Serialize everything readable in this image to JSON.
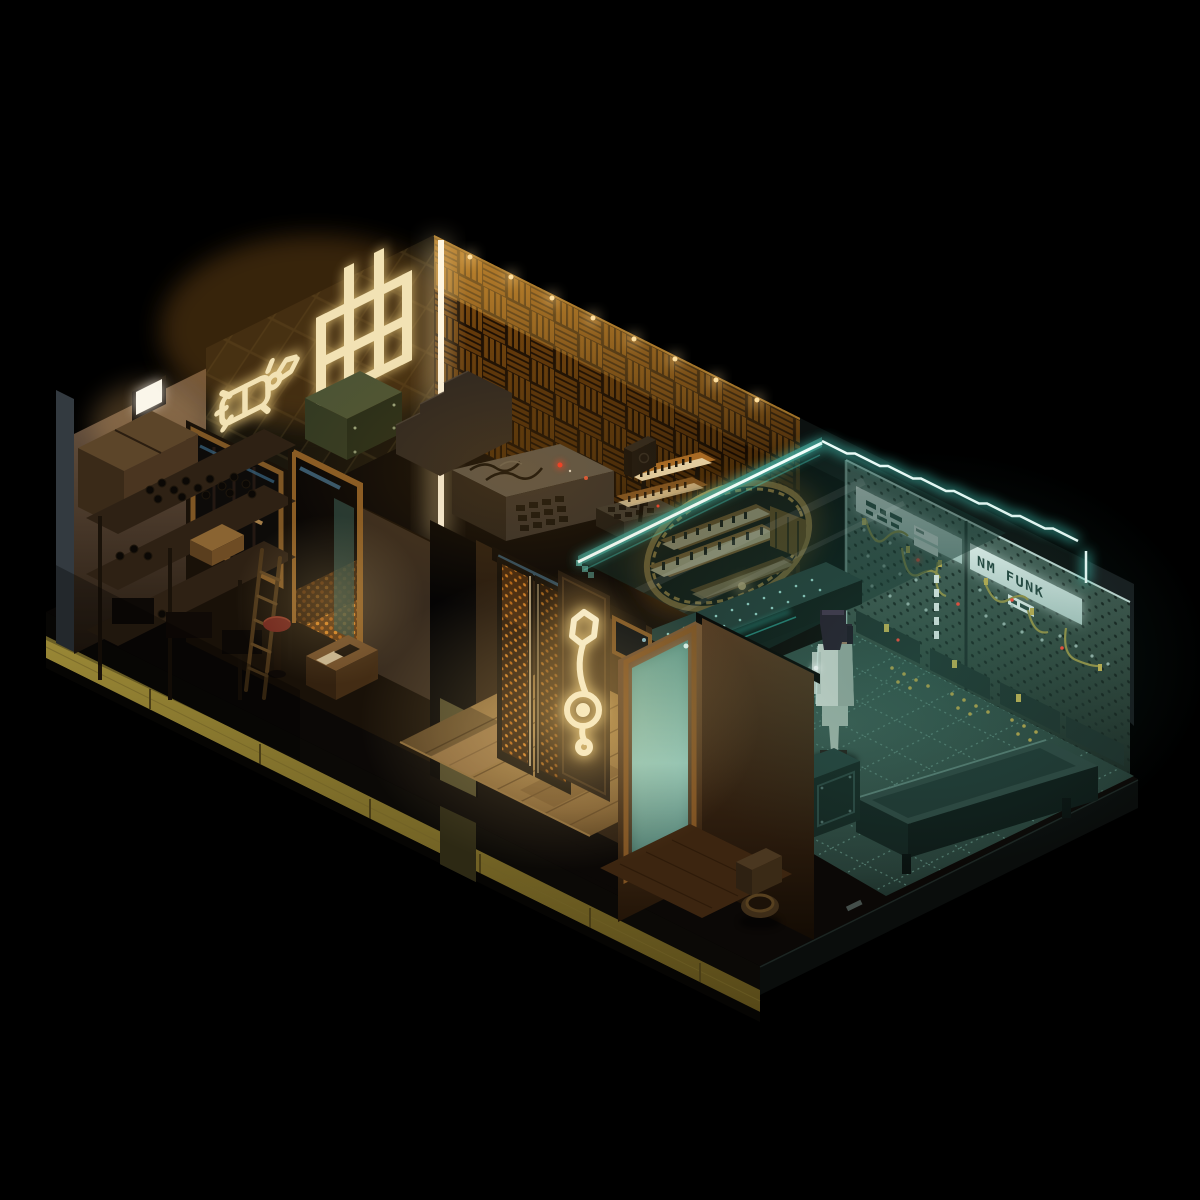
{
  "scene": {
    "style": "isometric-voxel-music-studio-diorama",
    "background_color": "#000000",
    "neon_kanji_sign": {
      "character": "曲",
      "companion_glyph": "beetle-icon",
      "color": "#f2e2b4"
    },
    "modular_synth_panel": {
      "label": "NM FUNK",
      "label_color": "#25453e",
      "panel_color": "#cfe4df"
    },
    "treble_clef_sign": {
      "symbol": "treble-clef",
      "color": "#f6ecca"
    },
    "accent_colors": {
      "warm_neon": "#f2e2b4",
      "warm_glow": "#c08a2e",
      "cyan_neon": "#eafcf8",
      "cyan_glow": "#46d8c8",
      "acoustic_foam": "#8a5210",
      "mustard_base": "#8a7832",
      "teal_wall": "#46605a",
      "teal_floor": "#29413c",
      "amber_emblem": "#b4873c"
    },
    "rooms": [
      "storage-room",
      "recording-studio",
      "entry-hall",
      "bathroom",
      "modular-synth-room"
    ],
    "figure": {
      "outfit_color": "#cbd6cd",
      "hair_color": "#241a28"
    }
  }
}
